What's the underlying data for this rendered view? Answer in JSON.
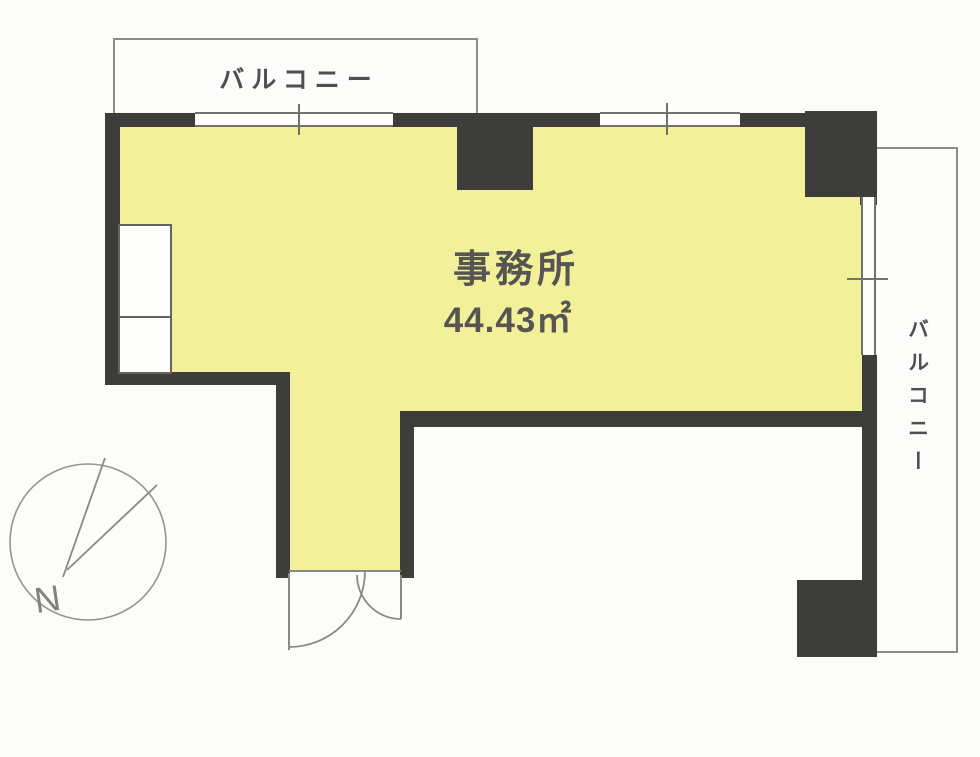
{
  "plan": {
    "room": {
      "label": "事務所",
      "area": "44.43㎡"
    },
    "balcony_top": {
      "label": "バルコニー"
    },
    "balcony_right": {
      "label": "バルコニー"
    },
    "compass": {
      "label": "N"
    }
  },
  "colors": {
    "floor_fill": "#f3f09a",
    "wall": "#3d3d3b",
    "outline": "#8d8d88",
    "text": "#565553",
    "background": "#fcfcfa"
  }
}
